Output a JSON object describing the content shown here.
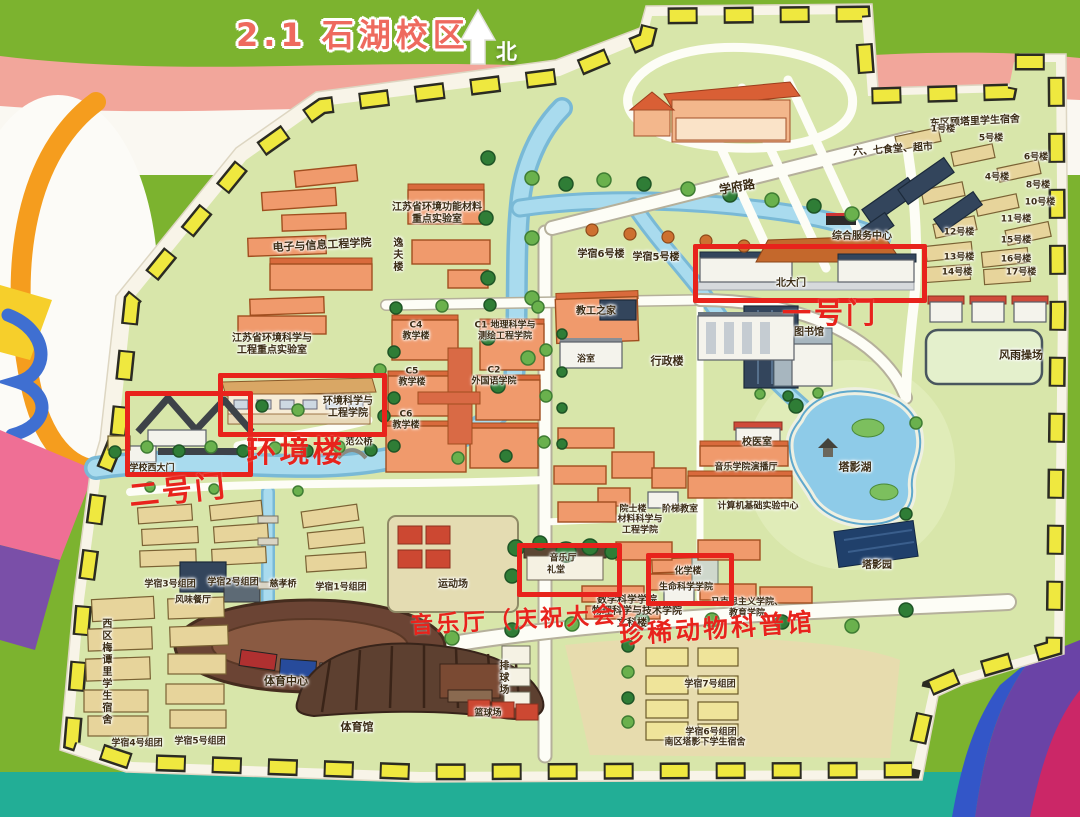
{
  "title": {
    "section": "2.1",
    "campus": "石湖校区"
  },
  "compass": {
    "north": "北"
  },
  "annotations": {
    "gate1": "一号门",
    "gate2": "二号门",
    "env_building": "环境楼",
    "music_hall": "音乐厅（庆祝大会）",
    "animal_museum": "珍稀动物科普馆"
  },
  "map_labels": [
    {
      "t": "学府路",
      "x": 737,
      "y": 187,
      "s": 12,
      "r": -10
    },
    {
      "t": "东区顾塔里学生宿舍",
      "x": 975,
      "y": 122,
      "s": 10,
      "r": -3
    },
    {
      "t": "六、七食堂、超市",
      "x": 893,
      "y": 150,
      "s": 10,
      "r": -4
    },
    {
      "t": "1号楼",
      "x": 943,
      "y": 130,
      "s": 9
    },
    {
      "t": "5号楼",
      "x": 991,
      "y": 139,
      "s": 9
    },
    {
      "t": "6号楼",
      "x": 1036,
      "y": 158,
      "s": 9
    },
    {
      "t": "4号楼",
      "x": 997,
      "y": 178,
      "s": 9
    },
    {
      "t": "8号楼",
      "x": 1038,
      "y": 186,
      "s": 9
    },
    {
      "t": "10号楼",
      "x": 1040,
      "y": 203,
      "s": 9
    },
    {
      "t": "11号楼",
      "x": 1016,
      "y": 220,
      "s": 9
    },
    {
      "t": "12号楼",
      "x": 959,
      "y": 233,
      "s": 9
    },
    {
      "t": "15号楼",
      "x": 1016,
      "y": 241,
      "s": 9
    },
    {
      "t": "13号楼",
      "x": 959,
      "y": 258,
      "s": 9
    },
    {
      "t": "16号楼",
      "x": 1016,
      "y": 260,
      "s": 9
    },
    {
      "t": "14号楼",
      "x": 957,
      "y": 273,
      "s": 9
    },
    {
      "t": "17号楼",
      "x": 1021,
      "y": 273,
      "s": 9
    },
    {
      "t": "综合服务中心",
      "x": 862,
      "y": 237,
      "s": 10
    },
    {
      "t": "北大门",
      "x": 791,
      "y": 284,
      "s": 10
    },
    {
      "t": "学宿6号楼",
      "x": 601,
      "y": 255,
      "s": 10
    },
    {
      "t": "学宿5号楼",
      "x": 656,
      "y": 258,
      "s": 10
    },
    {
      "t": "图书馆",
      "x": 809,
      "y": 333,
      "s": 10
    },
    {
      "t": "风雨操场",
      "x": 1021,
      "y": 356,
      "s": 11
    },
    {
      "t": "行政楼",
      "x": 667,
      "y": 362,
      "s": 11
    },
    {
      "t": "教工之家",
      "x": 596,
      "y": 312,
      "s": 10
    },
    {
      "t": "浴室",
      "x": 586,
      "y": 360,
      "s": 9
    },
    {
      "t": "C4\n教学楼",
      "x": 416,
      "y": 331,
      "s": 9
    },
    {
      "t": "C1 地理科学与\n测绘工程学院",
      "x": 505,
      "y": 331,
      "s": 9
    },
    {
      "t": "C5\n教学楼",
      "x": 412,
      "y": 377,
      "s": 9
    },
    {
      "t": "C2\n外国语学院",
      "x": 494,
      "y": 376,
      "s": 9
    },
    {
      "t": "C6\n教学楼",
      "x": 406,
      "y": 420,
      "s": 9
    },
    {
      "t": "江苏省环境功能材料\n重点实验室",
      "x": 437,
      "y": 214,
      "s": 10
    },
    {
      "t": "逸夫楼",
      "x": 396,
      "y": 255,
      "s": 10,
      "v": true
    },
    {
      "t": "电子与信息工程学院",
      "x": 322,
      "y": 246,
      "s": 11,
      "r": -3
    },
    {
      "t": "江苏省环境科学与\n工程重点实验室",
      "x": 272,
      "y": 345,
      "s": 10
    },
    {
      "t": "环境科学与\n工程学院",
      "x": 348,
      "y": 408,
      "s": 10
    },
    {
      "t": "学校西大门",
      "x": 152,
      "y": 469,
      "s": 9
    },
    {
      "t": "范公桥",
      "x": 359,
      "y": 443,
      "s": 9
    },
    {
      "t": "校医室",
      "x": 757,
      "y": 443,
      "s": 10
    },
    {
      "t": "音乐学院演播厅",
      "x": 746,
      "y": 468,
      "s": 9
    },
    {
      "t": "计算机基础实验中心",
      "x": 758,
      "y": 507,
      "s": 9
    },
    {
      "t": "塔影湖",
      "x": 855,
      "y": 468,
      "s": 11
    },
    {
      "t": "塔影园",
      "x": 877,
      "y": 566,
      "s": 10
    },
    {
      "t": "院士楼",
      "x": 633,
      "y": 510,
      "s": 9
    },
    {
      "t": "阶梯教室",
      "x": 680,
      "y": 510,
      "s": 9
    },
    {
      "t": "材料科学与\n工程学院",
      "x": 640,
      "y": 525,
      "s": 9
    },
    {
      "t": "音乐厅",
      "x": 563,
      "y": 559,
      "s": 9
    },
    {
      "t": "礼堂",
      "x": 556,
      "y": 571,
      "s": 9
    },
    {
      "t": "化学楼",
      "x": 688,
      "y": 572,
      "s": 9
    },
    {
      "t": "生命科学学院",
      "x": 686,
      "y": 588,
      "s": 9
    },
    {
      "t": "数学科学学院",
      "x": 627,
      "y": 601,
      "s": 10
    },
    {
      "t": "物理科学与技术学院",
      "x": 637,
      "y": 612,
      "s": 10
    },
    {
      "t": "文科楼",
      "x": 632,
      "y": 624,
      "s": 10
    },
    {
      "t": "马克思主义学院、\n教育学院",
      "x": 747,
      "y": 608,
      "s": 9
    },
    {
      "t": "运动场",
      "x": 453,
      "y": 585,
      "s": 10
    },
    {
      "t": "慈孝桥",
      "x": 283,
      "y": 585,
      "s": 9
    },
    {
      "t": "学宿3号组团",
      "x": 170,
      "y": 585,
      "s": 9
    },
    {
      "t": "学宿2号组团",
      "x": 233,
      "y": 583,
      "s": 9
    },
    {
      "t": "学宿1号组团",
      "x": 341,
      "y": 588,
      "s": 9
    },
    {
      "t": "风味餐厅",
      "x": 193,
      "y": 601,
      "s": 9
    },
    {
      "t": "西区梅谭里学生宿舍",
      "x": 105,
      "y": 672,
      "s": 10,
      "v": true
    },
    {
      "t": "学宿4号组团",
      "x": 137,
      "y": 744,
      "s": 9
    },
    {
      "t": "学宿5号组团",
      "x": 200,
      "y": 742,
      "s": 9
    },
    {
      "t": "体育中心",
      "x": 286,
      "y": 682,
      "s": 11
    },
    {
      "t": "体育馆",
      "x": 357,
      "y": 728,
      "s": 11
    },
    {
      "t": "排球场",
      "x": 502,
      "y": 678,
      "s": 10,
      "v": true
    },
    {
      "t": "篮球场",
      "x": 488,
      "y": 714,
      "s": 9
    },
    {
      "t": "学宿7号组团",
      "x": 710,
      "y": 685,
      "s": 9
    },
    {
      "t": "学宿6号组团",
      "x": 711,
      "y": 733,
      "s": 9
    },
    {
      "t": "南区塔影下学生宿舍",
      "x": 705,
      "y": 743,
      "s": 9
    }
  ],
  "colors": {
    "highlight_red": "#e8231c",
    "title_red": "#ee6a5e",
    "ground_green": "#d8e6aa",
    "water_blue": "#a9dbee",
    "band_pink": "#f2a69b",
    "band_teal": "#22ae96",
    "band_purple": "#6a43a6",
    "band_crimson": "#cb2767"
  }
}
